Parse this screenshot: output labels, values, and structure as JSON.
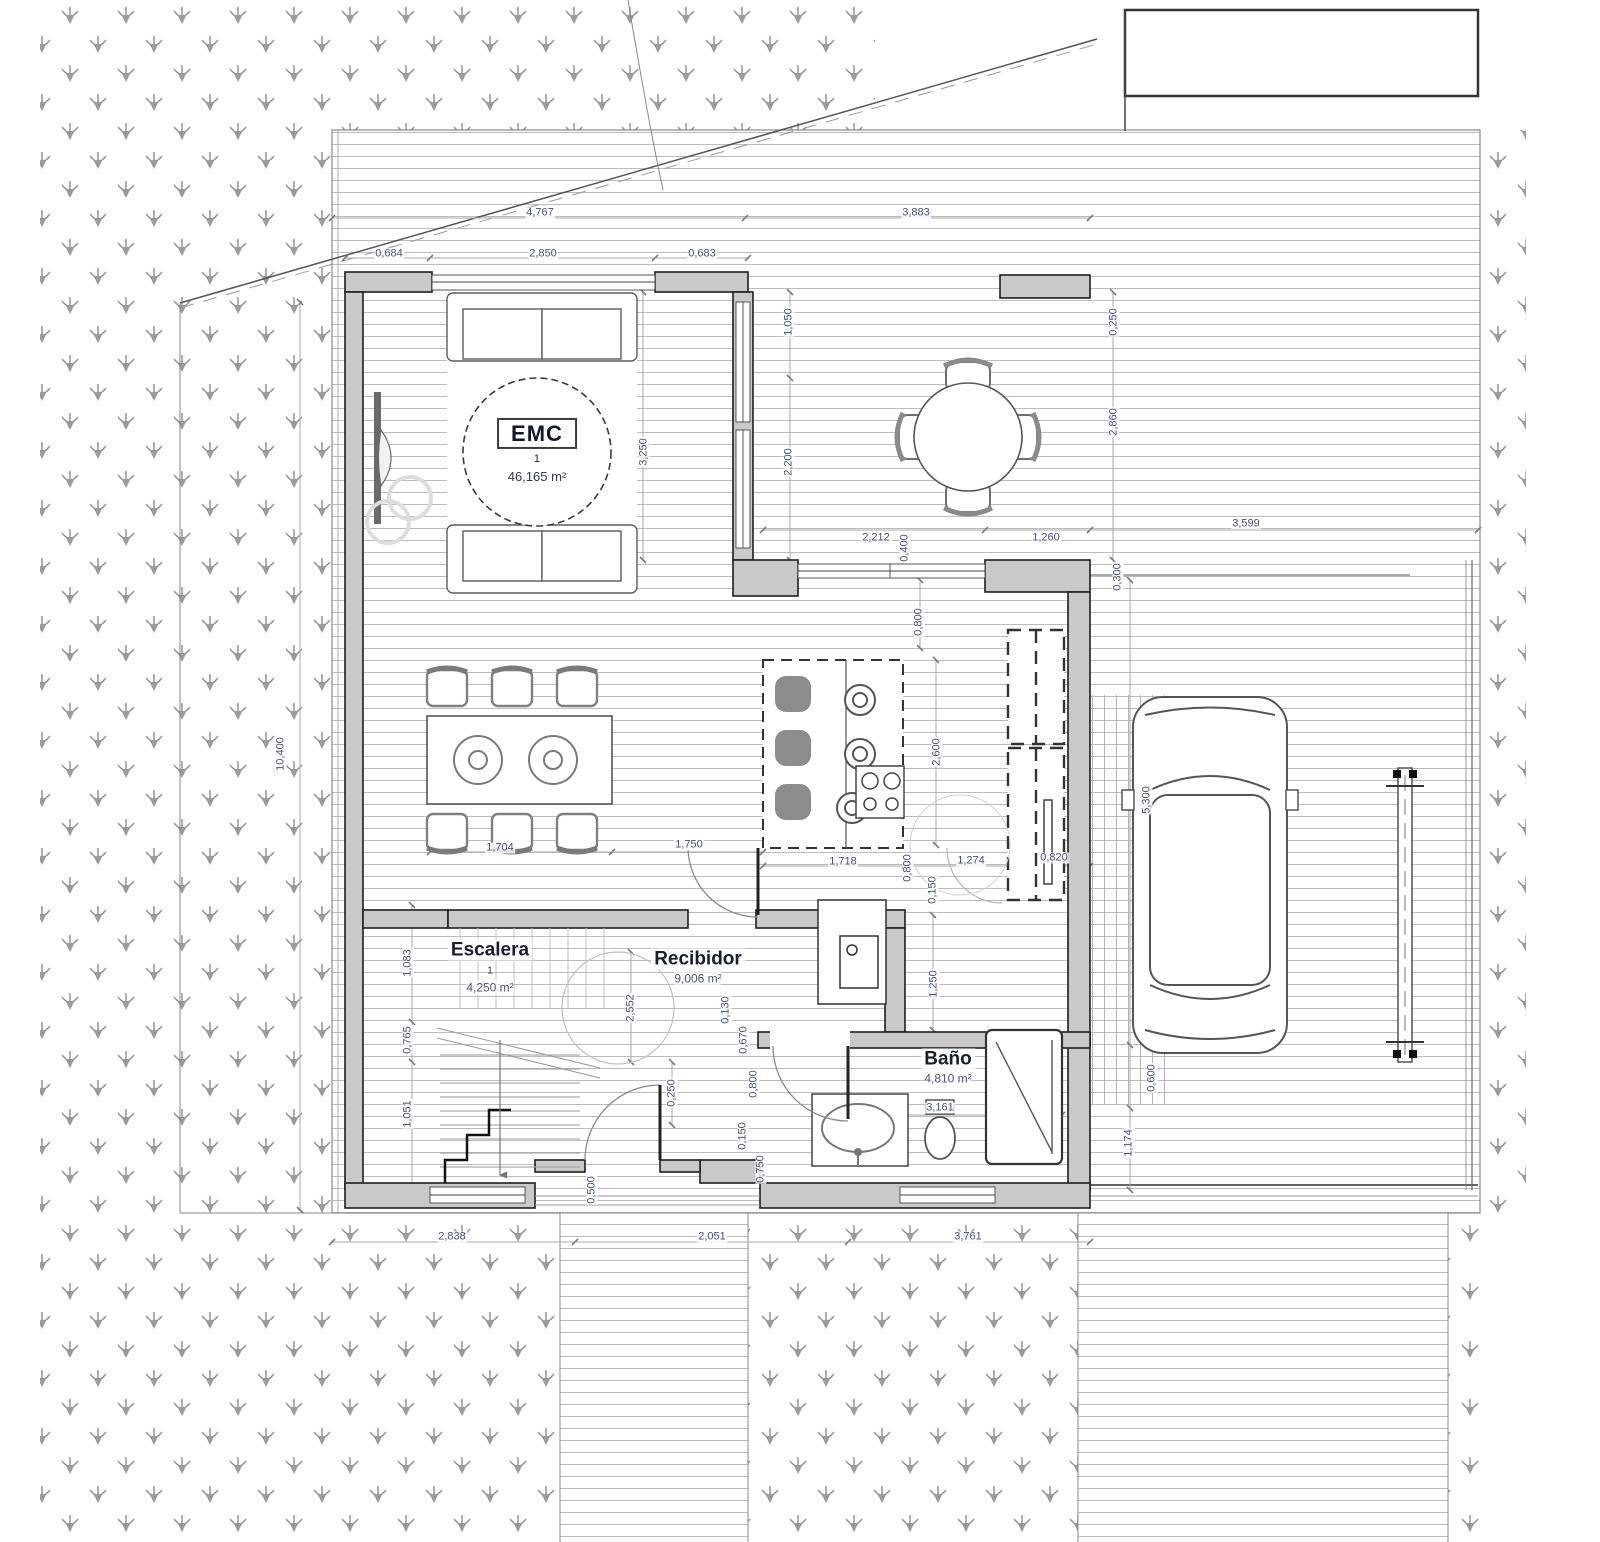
{
  "colors": {
    "wall_fill": "#c9c9c9",
    "wall_stroke": "#1e1e1e",
    "deck_line": "#bcbcbc",
    "grass_symbol": "#9a9a9a",
    "dimension_text": "#45507c",
    "dimension_line": "#a8a8a8",
    "furniture_stroke": "#6f6f6f",
    "room_name_text": "#18202f"
  },
  "rooms": {
    "emc": {
      "name": "EMC",
      "number": "1",
      "area": "46,165 m²"
    },
    "escalera": {
      "name": "Escalera",
      "number": "1",
      "area": "4,250 m²"
    },
    "recibidor": {
      "name": "Recibidor",
      "area": "9,006 m²"
    },
    "bano": {
      "name": "Baño",
      "area": "4,810 m²"
    }
  },
  "dimensions": {
    "labels": [
      {
        "t": "4,767",
        "x": 540,
        "y": 213,
        "r": 0
      },
      {
        "t": "3,883",
        "x": 916,
        "y": 213,
        "r": 0
      },
      {
        "t": "0,684",
        "x": 389,
        "y": 254,
        "r": 0
      },
      {
        "t": "2,850",
        "x": 543,
        "y": 254,
        "r": 0
      },
      {
        "t": "0,683",
        "x": 702,
        "y": 254,
        "r": 0
      },
      {
        "t": "1,050",
        "x": 789,
        "y": 322,
        "r": 90
      },
      {
        "t": "0,250",
        "x": 1114,
        "y": 322,
        "r": 90
      },
      {
        "t": "2,860",
        "x": 1114,
        "y": 422,
        "r": 90
      },
      {
        "t": "3,250",
        "x": 644,
        "y": 452,
        "r": 90
      },
      {
        "t": "2,200",
        "x": 789,
        "y": 462,
        "r": 90
      },
      {
        "t": "2,212",
        "x": 876,
        "y": 538,
        "r": 0
      },
      {
        "t": "0,400",
        "x": 905,
        "y": 548,
        "r": 90
      },
      {
        "t": "1,260",
        "x": 1046,
        "y": 538,
        "r": 0
      },
      {
        "t": "3,599",
        "x": 1246,
        "y": 524,
        "r": 0
      },
      {
        "t": "0,300",
        "x": 1118,
        "y": 577,
        "r": 90
      },
      {
        "t": "0,800",
        "x": 919,
        "y": 622,
        "r": 90
      },
      {
        "t": "2,600",
        "x": 937,
        "y": 752,
        "r": 90
      },
      {
        "t": "5,300",
        "x": 1147,
        "y": 800,
        "r": 90
      },
      {
        "t": "10,400",
        "x": 281,
        "y": 754,
        "r": 90
      },
      {
        "t": "1,704",
        "x": 500,
        "y": 848,
        "r": 0
      },
      {
        "t": "1,750",
        "x": 689,
        "y": 845,
        "r": 0
      },
      {
        "t": "1,718",
        "x": 843,
        "y": 862,
        "r": 0
      },
      {
        "t": "1,274",
        "x": 971,
        "y": 861,
        "r": 0
      },
      {
        "t": "0,820",
        "x": 1054,
        "y": 858,
        "r": 0
      },
      {
        "t": "0,800",
        "x": 908,
        "y": 868,
        "r": 90
      },
      {
        "t": "0,150",
        "x": 933,
        "y": 890,
        "r": 90
      },
      {
        "t": "1,250",
        "x": 934,
        "y": 984,
        "r": 90
      },
      {
        "t": "1,083",
        "x": 408,
        "y": 963,
        "r": 90
      },
      {
        "t": "0,765",
        "x": 408,
        "y": 1040,
        "r": 90
      },
      {
        "t": "1,051",
        "x": 408,
        "y": 1114,
        "r": 90
      },
      {
        "t": "2,552",
        "x": 631,
        "y": 1008,
        "r": 90
      },
      {
        "t": "0,130",
        "x": 726,
        "y": 1010,
        "r": 90
      },
      {
        "t": "0,670",
        "x": 744,
        "y": 1040,
        "r": 90
      },
      {
        "t": "0,800",
        "x": 754,
        "y": 1084,
        "r": 90
      },
      {
        "t": "0,250",
        "x": 672,
        "y": 1093,
        "r": 90
      },
      {
        "t": "0,150",
        "x": 743,
        "y": 1136,
        "r": 90
      },
      {
        "t": "0,750",
        "x": 761,
        "y": 1169,
        "r": 90
      },
      {
        "t": "0,500",
        "x": 592,
        "y": 1190,
        "r": 90
      },
      {
        "t": "3,161",
        "x": 940,
        "y": 1108,
        "r": 0
      },
      {
        "t": "0,600",
        "x": 1152,
        "y": 1078,
        "r": 90
      },
      {
        "t": "1,174",
        "x": 1129,
        "y": 1143,
        "r": 90
      },
      {
        "t": "2,838",
        "x": 452,
        "y": 1237,
        "r": 0
      },
      {
        "t": "2,051",
        "x": 712,
        "y": 1237,
        "r": 0
      },
      {
        "t": "3,761",
        "x": 968,
        "y": 1237,
        "r": 0
      }
    ]
  }
}
